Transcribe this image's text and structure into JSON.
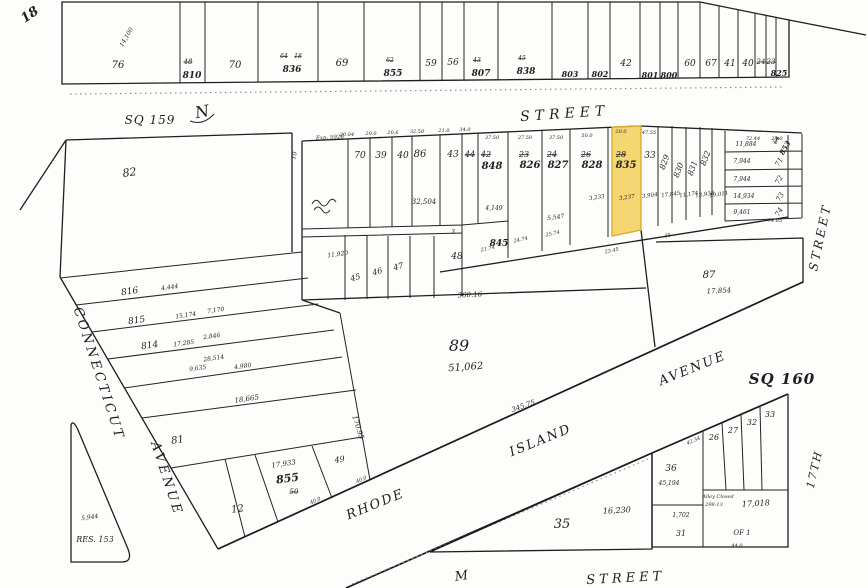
{
  "map": {
    "type": "plat-map",
    "square_left": "SQ 159",
    "square_right": "SQ 160",
    "page_number": "18",
    "highlighted_lot": {
      "lot": "835",
      "old_lot": "28",
      "area_sqft": "3,237"
    },
    "streets": {
      "north": "STREET",
      "west": [
        "CONNECTICUT",
        "AVENUE"
      ],
      "diagonal": [
        "RHODE",
        "ISLAND",
        "AVENUE"
      ],
      "east": [
        "STREET",
        "17TH"
      ],
      "south": [
        "M",
        "STREET"
      ]
    }
  },
  "colors": {
    "paper": "#fdfdfb",
    "ink": "#1f1f1f",
    "highlight_fill": "#f2cf5b",
    "highlight_stroke": "#d9a92c"
  },
  "labels": [
    {
      "n": "plat-page-number",
      "t": "18",
      "x": 32,
      "y": 18,
      "s": 13,
      "r": -35,
      "b": 1
    },
    {
      "n": "lot-76",
      "t": "76",
      "x": 118,
      "y": 68,
      "s": 10
    },
    {
      "n": "area-14100",
      "t": "14,100",
      "x": 128,
      "y": 38,
      "s": 6,
      "r": -60
    },
    {
      "n": "lot-810",
      "t": "810",
      "x": 192,
      "y": 78,
      "s": 9,
      "b": 1
    },
    {
      "n": "old-lot-48",
      "t": "48",
      "x": 188,
      "y": 64,
      "s": 7,
      "st": 1
    },
    {
      "n": "lot-70-top",
      "t": "70",
      "x": 235,
      "y": 68,
      "s": 10
    },
    {
      "n": "lot-836",
      "t": "836",
      "x": 292,
      "y": 72,
      "s": 9,
      "b": 1
    },
    {
      "n": "old-lot-64",
      "t": "64",
      "x": 284,
      "y": 58,
      "s": 6,
      "st": 1
    },
    {
      "n": "old-lot-18",
      "t": "18",
      "x": 298,
      "y": 58,
      "s": 6,
      "st": 1
    },
    {
      "n": "lot-69",
      "t": "69",
      "x": 342,
      "y": 66,
      "s": 10
    },
    {
      "n": "lot-855-top",
      "t": "855",
      "x": 393,
      "y": 76,
      "s": 9,
      "b": 1
    },
    {
      "n": "old-lot-62",
      "t": "62",
      "x": 390,
      "y": 62,
      "s": 6,
      "st": 1
    },
    {
      "n": "lot-59",
      "t": "59",
      "x": 431,
      "y": 66,
      "s": 9
    },
    {
      "n": "lot-56",
      "t": "56",
      "x": 453,
      "y": 65,
      "s": 9
    },
    {
      "n": "lot-807",
      "t": "807",
      "x": 481,
      "y": 76,
      "s": 9,
      "b": 1
    },
    {
      "n": "old-lot-43",
      "t": "43",
      "x": 477,
      "y": 62,
      "s": 6,
      "st": 1
    },
    {
      "n": "lot-838",
      "t": "838",
      "x": 526,
      "y": 74,
      "s": 9,
      "b": 1
    },
    {
      "n": "old-lot-45",
      "t": "45",
      "x": 522,
      "y": 60,
      "s": 6,
      "st": 1
    },
    {
      "n": "lot-803",
      "t": "803",
      "x": 570,
      "y": 77,
      "s": 8,
      "b": 1
    },
    {
      "n": "lot-802",
      "t": "802",
      "x": 600,
      "y": 77,
      "s": 8,
      "b": 1
    },
    {
      "n": "lot-42",
      "t": "42",
      "x": 626,
      "y": 66,
      "s": 9
    },
    {
      "n": "lot-801",
      "t": "801",
      "x": 650,
      "y": 78,
      "s": 8,
      "b": 1
    },
    {
      "n": "lot-800",
      "t": "800",
      "x": 669,
      "y": 78,
      "s": 8,
      "b": 1
    },
    {
      "n": "lot-60",
      "t": "60",
      "x": 690,
      "y": 66,
      "s": 9
    },
    {
      "n": "lot-67",
      "t": "67",
      "x": 711,
      "y": 66,
      "s": 9
    },
    {
      "n": "lot-41",
      "t": "41",
      "x": 730,
      "y": 66,
      "s": 9
    },
    {
      "n": "lot-40",
      "t": "40",
      "x": 748,
      "y": 66,
      "s": 9
    },
    {
      "n": "old-lot-24",
      "t": "24",
      "x": 761,
      "y": 64,
      "s": 7,
      "st": 1
    },
    {
      "n": "old-lot-23",
      "t": "23",
      "x": 771,
      "y": 64,
      "s": 7,
      "st": 1
    },
    {
      "n": "lot-825",
      "t": "825",
      "x": 779,
      "y": 76,
      "s": 8,
      "b": 1
    },
    {
      "n": "square-label-sq159",
      "t": "SQ 159",
      "x": 150,
      "y": 124,
      "s": 12,
      "ls": 1
    },
    {
      "n": "north-arrow-letter",
      "t": "N",
      "x": 203,
      "y": 117,
      "s": 16,
      "r": -10
    },
    {
      "n": "street-name-north",
      "t": "STREET",
      "x": 565,
      "y": 118,
      "s": 14,
      "ls": 5,
      "r": -4
    },
    {
      "n": "note-exp",
      "t": "Exp. 5926",
      "x": 330,
      "y": 139,
      "s": 5.5,
      "r": -3
    },
    {
      "n": "dim-alley-10",
      "t": "10",
      "x": 296,
      "y": 156,
      "s": 6,
      "r": -75
    },
    {
      "n": "lot-82",
      "t": "82",
      "x": 130,
      "y": 176,
      "s": 11,
      "r": -8
    },
    {
      "n": "lot-70",
      "t": "70",
      "x": 360,
      "y": 158,
      "s": 9
    },
    {
      "n": "lot-39",
      "t": "39",
      "x": 381,
      "y": 158,
      "s": 9
    },
    {
      "n": "lot-40-mid",
      "t": "40",
      "x": 403,
      "y": 158,
      "s": 9
    },
    {
      "n": "lot-86",
      "t": "86",
      "x": 420,
      "y": 157,
      "s": 10
    },
    {
      "n": "area-32504",
      "t": "32,504",
      "x": 424,
      "y": 204,
      "s": 7
    },
    {
      "n": "lot-43",
      "t": "43",
      "x": 453,
      "y": 157,
      "s": 9
    },
    {
      "n": "old-lot-44",
      "t": "44",
      "x": 470,
      "y": 157,
      "s": 8,
      "st": 1
    },
    {
      "n": "old-lot-42",
      "t": "42",
      "x": 486,
      "y": 157,
      "s": 8,
      "st": 1
    },
    {
      "n": "lot-848",
      "t": "848",
      "x": 492,
      "y": 169,
      "s": 10,
      "b": 1
    },
    {
      "n": "old-lot-23b",
      "t": "23",
      "x": 524,
      "y": 157,
      "s": 8,
      "st": 1
    },
    {
      "n": "lot-826",
      "t": "826",
      "x": 530,
      "y": 168,
      "s": 10,
      "b": 1
    },
    {
      "n": "old-lot-24b",
      "t": "24",
      "x": 552,
      "y": 157,
      "s": 8,
      "st": 1
    },
    {
      "n": "lot-827",
      "t": "827",
      "x": 558,
      "y": 168,
      "s": 10,
      "b": 1
    },
    {
      "n": "old-lot-26",
      "t": "26",
      "x": 586,
      "y": 157,
      "s": 8,
      "st": 1
    },
    {
      "n": "lot-828",
      "t": "828",
      "x": 592,
      "y": 168,
      "s": 10,
      "b": 1
    },
    {
      "n": "old-lot-28",
      "t": "28",
      "x": 621,
      "y": 157,
      "s": 8,
      "st": 1
    },
    {
      "n": "lot-835-highlighted",
      "t": "835",
      "x": 626,
      "y": 168,
      "s": 10,
      "b": 1
    },
    {
      "n": "lot-33",
      "t": "33",
      "x": 650,
      "y": 158,
      "s": 9
    },
    {
      "n": "lot-829",
      "t": "829",
      "x": 667,
      "y": 163,
      "s": 8,
      "r": -70
    },
    {
      "n": "lot-830",
      "t": "830",
      "x": 681,
      "y": 171,
      "s": 8,
      "r": -70
    },
    {
      "n": "lot-831",
      "t": "831",
      "x": 695,
      "y": 169,
      "s": 8,
      "r": -70
    },
    {
      "n": "lot-832",
      "t": "832",
      "x": 708,
      "y": 159,
      "s": 8,
      "r": -70
    },
    {
      "n": "area-11884",
      "t": "11,884",
      "x": 746,
      "y": 146,
      "s": 6
    },
    {
      "n": "old-lot-64b",
      "t": "64",
      "x": 778,
      "y": 141,
      "s": 6,
      "st": 1,
      "r": -60
    },
    {
      "n": "lot-853",
      "t": "853",
      "x": 787,
      "y": 149,
      "s": 7,
      "r": -60,
      "b": 1
    },
    {
      "n": "area-7944-a",
      "t": "7,944",
      "x": 742,
      "y": 163,
      "s": 6
    },
    {
      "n": "lot-71",
      "t": "71",
      "x": 781,
      "y": 163,
      "s": 7,
      "r": -60
    },
    {
      "n": "area-7944-b",
      "t": "7,944",
      "x": 742,
      "y": 181,
      "s": 6
    },
    {
      "n": "lot-72",
      "t": "72",
      "x": 781,
      "y": 181,
      "s": 7,
      "r": -60
    },
    {
      "n": "area-14934",
      "t": "14,934",
      "x": 744,
      "y": 198,
      "s": 6
    },
    {
      "n": "lot-73",
      "t": "73",
      "x": 782,
      "y": 198,
      "s": 7,
      "r": -60
    },
    {
      "n": "area-9461",
      "t": "9,461",
      "x": 742,
      "y": 214,
      "s": 6
    },
    {
      "n": "lot-74",
      "t": "74",
      "x": 781,
      "y": 213,
      "s": 7,
      "r": -60
    },
    {
      "n": "dim-74-85",
      "t": "74.85",
      "x": 775,
      "y": 222,
      "s": 5
    },
    {
      "n": "area-3233",
      "t": "3,233",
      "x": 597,
      "y": 199,
      "s": 5.5,
      "r": -8
    },
    {
      "n": "area-3237",
      "t": "3,237",
      "x": 627,
      "y": 199,
      "s": 5.5,
      "r": -8
    },
    {
      "n": "area-3904",
      "t": "3,904",
      "x": 650,
      "y": 197,
      "s": 5.5,
      "r": -8
    },
    {
      "n": "area-17845",
      "t": "17,845",
      "x": 671,
      "y": 196,
      "s": 5.5,
      "r": -8
    },
    {
      "n": "area-11174",
      "t": "11,174",
      "x": 689,
      "y": 196,
      "s": 5.5,
      "r": -8
    },
    {
      "n": "area-13938",
      "t": "13,938",
      "x": 705,
      "y": 196,
      "s": 5.5,
      "r": -8
    },
    {
      "n": "area-19011",
      "t": "19,011",
      "x": 719,
      "y": 196,
      "s": 5.5,
      "r": -8
    },
    {
      "n": "area-4149",
      "t": "4,149",
      "x": 494,
      "y": 210,
      "s": 6
    },
    {
      "n": "area-5547",
      "t": "5,547",
      "x": 556,
      "y": 219,
      "s": 6,
      "r": -8
    },
    {
      "n": "lot-45",
      "t": "45",
      "x": 356,
      "y": 280,
      "s": 8,
      "r": -15
    },
    {
      "n": "lot-46",
      "t": "46",
      "x": 378,
      "y": 274,
      "s": 8,
      "r": -15
    },
    {
      "n": "lot-47",
      "t": "47",
      "x": 399,
      "y": 269,
      "s": 8,
      "r": -15
    },
    {
      "n": "lot-48",
      "t": "48",
      "x": 457,
      "y": 259,
      "s": 9
    },
    {
      "n": "lot-845",
      "t": "845",
      "x": 499,
      "y": 246,
      "s": 9,
      "b": 1
    },
    {
      "n": "area-11920",
      "t": "11,920",
      "x": 338,
      "y": 256,
      "s": 6,
      "r": -8
    },
    {
      "n": "dim-21-74",
      "t": "21.74",
      "x": 488,
      "y": 250,
      "s": 5,
      "r": -12
    },
    {
      "n": "dim-24-74",
      "t": "24.74",
      "x": 521,
      "y": 241,
      "s": 5,
      "r": -12
    },
    {
      "n": "dim-25-74",
      "t": "25.74",
      "x": 553,
      "y": 235,
      "s": 5,
      "r": -12
    },
    {
      "n": "dim-23-45",
      "t": "23.45",
      "x": 612,
      "y": 252,
      "s": 5,
      "r": -12
    },
    {
      "n": "dim-35",
      "t": "35",
      "x": 668,
      "y": 237,
      "s": 5,
      "r": -12
    },
    {
      "n": "dim-3",
      "t": "3",
      "x": 453,
      "y": 234,
      "s": 6
    },
    {
      "n": "dim-20-84",
      "t": "20.84",
      "x": 347,
      "y": 136,
      "s": 5
    },
    {
      "n": "dim-20-0a",
      "t": "20.0",
      "x": 371,
      "y": 135,
      "s": 5
    },
    {
      "n": "dim-20-6",
      "t": "20.6",
      "x": 393,
      "y": 134,
      "s": 5
    },
    {
      "n": "dim-32-50",
      "t": "32.50",
      "x": 417,
      "y": 133,
      "s": 5
    },
    {
      "n": "dim-21-0",
      "t": "21.0",
      "x": 444,
      "y": 132,
      "s": 5
    },
    {
      "n": "dim-34-0",
      "t": "34.0",
      "x": 465,
      "y": 131,
      "s": 5
    },
    {
      "n": "dim-37-50a",
      "t": "37.50",
      "x": 492,
      "y": 139,
      "s": 5
    },
    {
      "n": "dim-27-50",
      "t": "27.50",
      "x": 525,
      "y": 139,
      "s": 5
    },
    {
      "n": "dim-37-50b",
      "t": "37.50",
      "x": 556,
      "y": 139,
      "s": 5
    },
    {
      "n": "dim-50-0",
      "t": "50.0",
      "x": 587,
      "y": 137,
      "s": 5
    },
    {
      "n": "dim-20-0b",
      "t": "20.0",
      "x": 621,
      "y": 133,
      "s": 5
    },
    {
      "n": "dim-47-55",
      "t": "47.55",
      "x": 649,
      "y": 134,
      "s": 5
    },
    {
      "n": "dim-72-44",
      "t": "72.44",
      "x": 753,
      "y": 140,
      "s": 5
    },
    {
      "n": "dim-24-0",
      "t": "24.0",
      "x": 777,
      "y": 140,
      "s": 5
    },
    {
      "n": "lot-89",
      "t": "89",
      "x": 459,
      "y": 351,
      "s": 16
    },
    {
      "n": "area-51062",
      "t": "51,062",
      "x": 466,
      "y": 370,
      "s": 10,
      "r": -4
    },
    {
      "n": "dim-360-16",
      "t": "360.16",
      "x": 470,
      "y": 297,
      "s": 7,
      "r": -3
    },
    {
      "n": "dim-345-75",
      "t": "345.75",
      "x": 524,
      "y": 408,
      "s": 7,
      "r": -20
    },
    {
      "n": "dim-170-95",
      "t": "170.95",
      "x": 356,
      "y": 428,
      "s": 7,
      "r": 72
    },
    {
      "n": "lot-87",
      "t": "87",
      "x": 709,
      "y": 278,
      "s": 10
    },
    {
      "n": "area-17854",
      "t": "17,854",
      "x": 719,
      "y": 293,
      "s": 7,
      "r": -3
    },
    {
      "n": "lot-816",
      "t": "816",
      "x": 130,
      "y": 294,
      "s": 9,
      "r": -8
    },
    {
      "n": "area-4444",
      "t": "4,444",
      "x": 170,
      "y": 289,
      "s": 6,
      "r": -8
    },
    {
      "n": "lot-815",
      "t": "815",
      "x": 137,
      "y": 323,
      "s": 9,
      "r": -8
    },
    {
      "n": "area-15174",
      "t": "15,174",
      "x": 186,
      "y": 317,
      "s": 6,
      "r": -8
    },
    {
      "n": "area-7170",
      "t": "7,170",
      "x": 216,
      "y": 312,
      "s": 6,
      "r": -8
    },
    {
      "n": "lot-814",
      "t": "814",
      "x": 150,
      "y": 348,
      "s": 9,
      "r": -8
    },
    {
      "n": "area-17285",
      "t": "17,285",
      "x": 184,
      "y": 345,
      "s": 6,
      "r": -8
    },
    {
      "n": "area-2846",
      "t": "2,846",
      "x": 212,
      "y": 338,
      "s": 6,
      "r": -8
    },
    {
      "n": "area-28514",
      "t": "28,514",
      "x": 214,
      "y": 360,
      "s": 6,
      "r": -8
    },
    {
      "n": "area-9635",
      "t": "9,635",
      "x": 198,
      "y": 370,
      "s": 6,
      "r": -8
    },
    {
      "n": "area-4980",
      "t": "4,980",
      "x": 243,
      "y": 368,
      "s": 6,
      "r": -8
    },
    {
      "n": "area-18665",
      "t": "18,665",
      "x": 247,
      "y": 401,
      "s": 7,
      "r": -8
    },
    {
      "n": "lot-81",
      "t": "81",
      "x": 178,
      "y": 443,
      "s": 10,
      "r": -8
    },
    {
      "n": "lot-12",
      "t": "12",
      "x": 238,
      "y": 512,
      "s": 10,
      "r": -8
    },
    {
      "n": "lot-855",
      "t": "855",
      "x": 288,
      "y": 482,
      "s": 11,
      "b": 1,
      "r": -8
    },
    {
      "n": "area-17933",
      "t": "17,933",
      "x": 284,
      "y": 466,
      "s": 7,
      "r": -8
    },
    {
      "n": "old-lot-50",
      "t": "50",
      "x": 294,
      "y": 494,
      "s": 7,
      "st": 1
    },
    {
      "n": "lot-49",
      "t": "49",
      "x": 340,
      "y": 462,
      "s": 8,
      "r": -8
    },
    {
      "n": "dim-40-0a",
      "t": "40.0",
      "x": 316,
      "y": 502,
      "s": 5,
      "r": -24
    },
    {
      "n": "dim-40-0b",
      "t": "40.0",
      "x": 362,
      "y": 481,
      "s": 5,
      "r": -24
    },
    {
      "n": "area-5944",
      "t": "5,944",
      "x": 90,
      "y": 519,
      "s": 6,
      "r": -8
    },
    {
      "n": "reservation-label",
      "t": "RES. 153",
      "x": 95,
      "y": 542,
      "s": 8
    },
    {
      "n": "street-name-connecticut",
      "t": "CONNECTICUT",
      "x": 95,
      "y": 375,
      "s": 13,
      "ls": 3,
      "r": 72
    },
    {
      "n": "street-name-avenue-west",
      "t": "AVENUE",
      "x": 163,
      "y": 480,
      "s": 13,
      "ls": 3,
      "r": 72
    },
    {
      "n": "street-name-rhode",
      "t": "RHODE",
      "x": 377,
      "y": 508,
      "s": 13,
      "ls": 2,
      "r": -22
    },
    {
      "n": "street-name-island",
      "t": "ISLAND",
      "x": 542,
      "y": 444,
      "s": 13,
      "ls": 2,
      "r": -22
    },
    {
      "n": "street-name-avenue-diag",
      "t": "AVENUE",
      "x": 694,
      "y": 372,
      "s": 13,
      "ls": 2,
      "r": -22
    },
    {
      "n": "square-label-sq160",
      "t": "SQ 160",
      "x": 782,
      "y": 384,
      "s": 15,
      "b": 1,
      "ls": 1
    },
    {
      "n": "dim-42-34",
      "t": "42.34",
      "x": 694,
      "y": 442,
      "s": 5,
      "r": -24
    },
    {
      "n": "lot-26",
      "t": "26",
      "x": 714,
      "y": 440,
      "s": 8
    },
    {
      "n": "lot-27",
      "t": "27",
      "x": 733,
      "y": 433,
      "s": 8
    },
    {
      "n": "lot-32",
      "t": "32",
      "x": 752,
      "y": 425,
      "s": 8
    },
    {
      "n": "lot-33-sq160",
      "t": "33",
      "x": 770,
      "y": 417,
      "s": 8
    },
    {
      "n": "lot-36",
      "t": "36",
      "x": 671,
      "y": 471,
      "s": 9
    },
    {
      "n": "area-45194",
      "t": "45,194",
      "x": 669,
      "y": 485,
      "s": 6
    },
    {
      "n": "lot-31",
      "t": "31",
      "x": 681,
      "y": 536,
      "s": 8
    },
    {
      "n": "area-1702",
      "t": "1,702",
      "x": 681,
      "y": 517,
      "s": 6
    },
    {
      "n": "note-alley-closed",
      "t": "Alley Closed",
      "x": 718,
      "y": 498,
      "s": 5
    },
    {
      "n": "note-alley-ref",
      "t": "298-13",
      "x": 714,
      "y": 506,
      "s": 5
    },
    {
      "n": "area-17018",
      "t": "17,018",
      "x": 756,
      "y": 506,
      "s": 8,
      "r": -3
    },
    {
      "n": "note-of-1",
      "t": "OF 1",
      "x": 742,
      "y": 535,
      "s": 7
    },
    {
      "n": "dim-44-0",
      "t": "44.0",
      "x": 737,
      "y": 547,
      "s": 5
    },
    {
      "n": "lot-35",
      "t": "35",
      "x": 562,
      "y": 528,
      "s": 13
    },
    {
      "n": "area-16230",
      "t": "16,230",
      "x": 617,
      "y": 513,
      "s": 8,
      "r": -3
    },
    {
      "n": "street-name-17th",
      "t": "17TH",
      "x": 818,
      "y": 470,
      "s": 11,
      "r": -77,
      "ls": 2
    },
    {
      "n": "street-name-east",
      "t": "STREET",
      "x": 824,
      "y": 238,
      "s": 12,
      "r": -78,
      "ls": 3
    },
    {
      "n": "street-name-m",
      "t": "M",
      "x": 462,
      "y": 580,
      "s": 13,
      "r": -8
    },
    {
      "n": "street-name-south",
      "t": "STREET",
      "x": 626,
      "y": 582,
      "s": 13,
      "ls": 4,
      "r": -3
    }
  ]
}
